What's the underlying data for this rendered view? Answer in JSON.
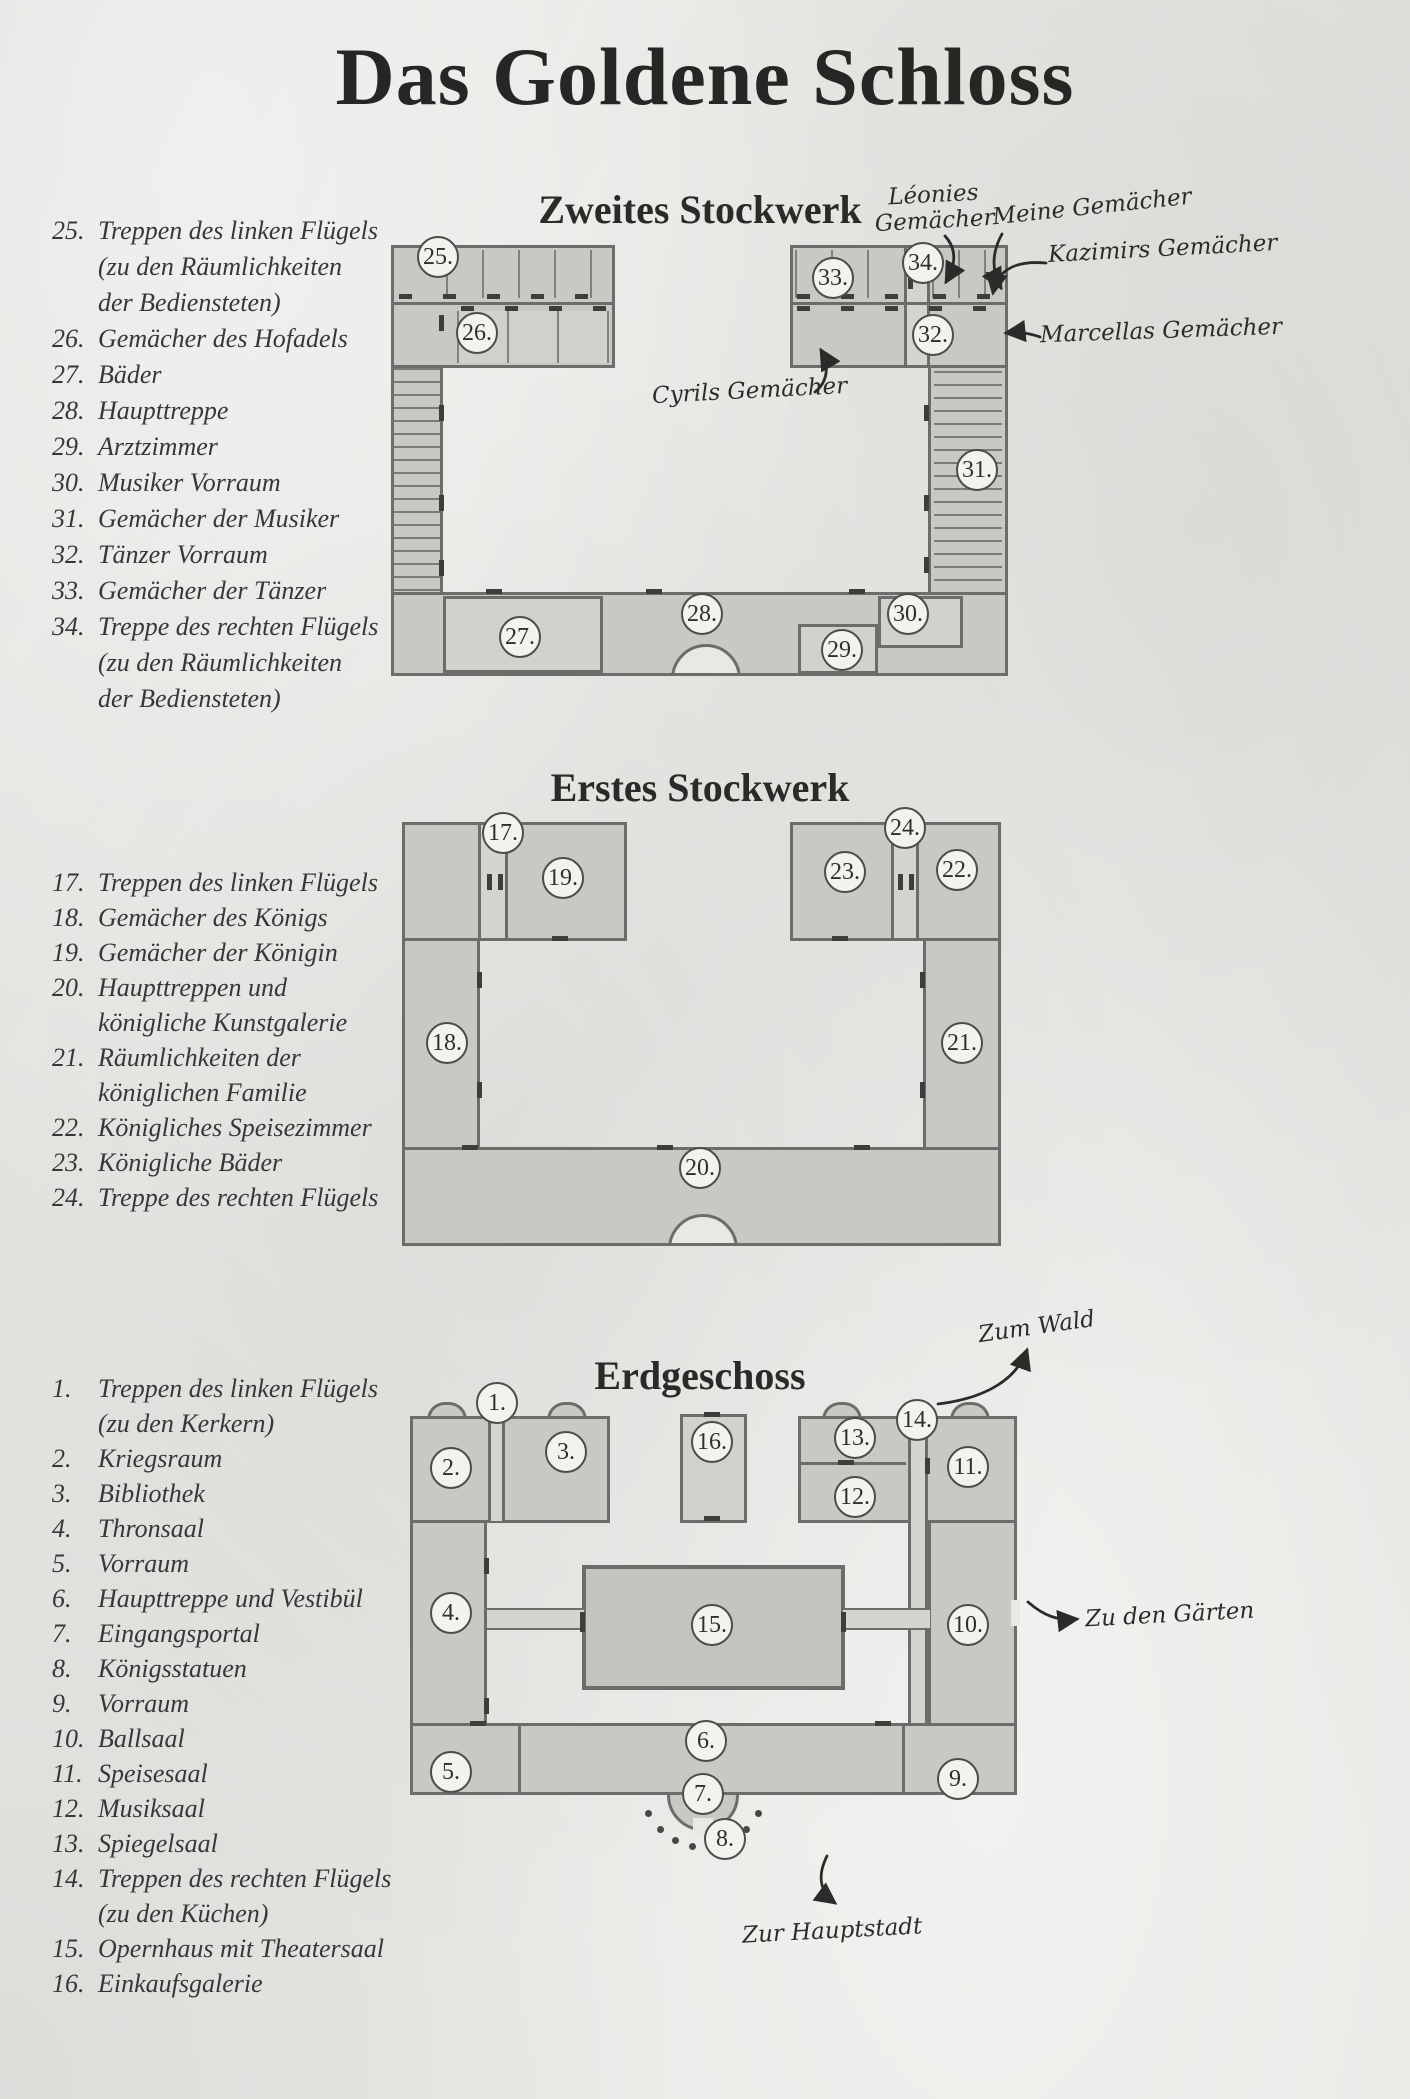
{
  "title": "Das Goldene Schloss",
  "colors": {
    "paper": "#eae8e5",
    "plan_fill": "#cac8c4",
    "plan_border": "#6d6c6a",
    "ink": "#2e2e2c"
  },
  "floor2": {
    "title": "Zweites Stockwerk",
    "legend": [
      {
        "num": "25.",
        "text": "Treppen des linken Flügels"
      },
      {
        "num": "",
        "text": "(zu den Räumlichkeiten"
      },
      {
        "num": "",
        "text": "der Bediensteten)"
      },
      {
        "num": "26.",
        "text": "Gemächer des Hofadels"
      },
      {
        "num": "27.",
        "text": "Bäder"
      },
      {
        "num": "28.",
        "text": "Haupttreppe"
      },
      {
        "num": "29.",
        "text": "Arztzimmer"
      },
      {
        "num": "30.",
        "text": "Musiker Vorraum"
      },
      {
        "num": "31.",
        "text": "Gemächer der Musiker"
      },
      {
        "num": "32.",
        "text": "Tänzer Vorraum"
      },
      {
        "num": "33.",
        "text": "Gemächer der Tänzer"
      },
      {
        "num": "34.",
        "text": "Treppe des rechten Flügels"
      },
      {
        "num": "",
        "text": "(zu den Räumlichkeiten"
      },
      {
        "num": "",
        "text": "der Bediensteten)"
      }
    ],
    "rooms": [
      "25.",
      "26.",
      "27.",
      "28.",
      "29.",
      "30.",
      "31.",
      "32.",
      "33.",
      "34."
    ],
    "annotations": {
      "leonies_line1": "Léonies",
      "leonies_line2": "Gemächer",
      "meine": "Meine Gemächer",
      "kazimirs": "Kazimirs Gemächer",
      "marcellas": "Marcellas Gemächer",
      "cyrils": "Cyrils Gemächer"
    }
  },
  "floor1": {
    "title": "Erstes Stockwerk",
    "legend": [
      {
        "num": "17.",
        "text": "Treppen des linken Flügels"
      },
      {
        "num": "18.",
        "text": "Gemächer des Königs"
      },
      {
        "num": "19.",
        "text": "Gemächer der Königin"
      },
      {
        "num": "20.",
        "text": "Haupttreppen und"
      },
      {
        "num": "",
        "text": "königliche Kunstgalerie"
      },
      {
        "num": "21.",
        "text": "Räumlichkeiten der"
      },
      {
        "num": "",
        "text": "königlichen Familie"
      },
      {
        "num": "22.",
        "text": "Königliches Speisezimmer"
      },
      {
        "num": "23.",
        "text": "Königliche Bäder"
      },
      {
        "num": "24.",
        "text": "Treppe des rechten Flügels"
      }
    ],
    "rooms": [
      "17.",
      "18.",
      "19.",
      "20.",
      "21.",
      "22.",
      "23.",
      "24."
    ]
  },
  "floor0": {
    "title": "Erdgeschoss",
    "legend": [
      {
        "num": "1.",
        "text": "Treppen des linken Flügels"
      },
      {
        "num": "",
        "text": "(zu den Kerkern)"
      },
      {
        "num": "2.",
        "text": "Kriegsraum"
      },
      {
        "num": "3.",
        "text": "Bibliothek"
      },
      {
        "num": "4.",
        "text": "Thronsaal"
      },
      {
        "num": "5.",
        "text": "Vorraum"
      },
      {
        "num": "6.",
        "text": "Haupttreppe und Vestibül"
      },
      {
        "num": "7.",
        "text": "Eingangsportal"
      },
      {
        "num": "8.",
        "text": "Königsstatuen"
      },
      {
        "num": "9.",
        "text": "Vorraum"
      },
      {
        "num": "10.",
        "text": "Ballsaal"
      },
      {
        "num": "11.",
        "text": "Speisesaal"
      },
      {
        "num": "12.",
        "text": "Musiksaal"
      },
      {
        "num": "13.",
        "text": "Spiegelsaal"
      },
      {
        "num": "14.",
        "text": "Treppen des rechten Flügels"
      },
      {
        "num": "",
        "text": "(zu den Küchen)"
      },
      {
        "num": "15.",
        "text": "Opernhaus mit Theatersaal"
      },
      {
        "num": "16.",
        "text": "Einkaufsgalerie"
      }
    ],
    "rooms": [
      "1.",
      "2.",
      "3.",
      "4.",
      "5.",
      "6.",
      "7.",
      "8.",
      "9.",
      "10.",
      "11.",
      "12.",
      "13.",
      "14.",
      "15.",
      "16."
    ],
    "annotations": {
      "wald": "Zum Wald",
      "gaerten": "Zu den Gärten",
      "hauptstadt": "Zur Hauptstadt"
    }
  }
}
